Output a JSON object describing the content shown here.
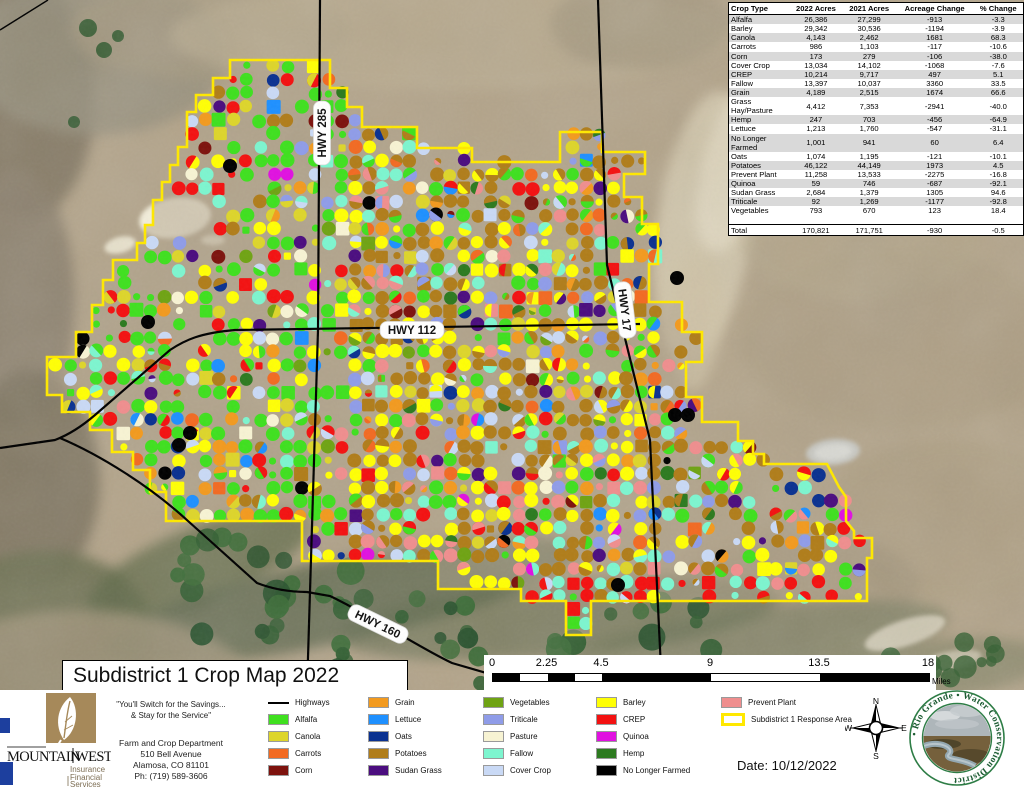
{
  "title": "Subdistrict 1 Crop Map 2022",
  "date_label": "Date: 10/12/2022",
  "highways": [
    "HWY 285",
    "HWY 112",
    "HWY 17",
    "HWY 160"
  ],
  "table": {
    "headers": [
      "Crop Type",
      "2022 Acres",
      "2021 Acres",
      "Acreage Change",
      "% Change"
    ],
    "rows": [
      [
        "Alfalfa",
        "26,386",
        "27,299",
        "-913",
        "-3.3"
      ],
      [
        "Barley",
        "29,342",
        "30,536",
        "-1194",
        "-3.9"
      ],
      [
        "Canola",
        "4,143",
        "2,462",
        "1681",
        "68.3"
      ],
      [
        "Carrots",
        "986",
        "1,103",
        "-117",
        "-10.6"
      ],
      [
        "Corn",
        "173",
        "279",
        "-106",
        "-38.0"
      ],
      [
        "Cover Crop",
        "13,034",
        "14,102",
        "-1068",
        "-7.6"
      ],
      [
        "CREP",
        "10,214",
        "9,717",
        "497",
        "5.1"
      ],
      [
        "Fallow",
        "13,397",
        "10,037",
        "3360",
        "33.5"
      ],
      [
        "Grain",
        "4,189",
        "2,515",
        "1674",
        "66.6"
      ],
      [
        "Grass\nHay/Pasture",
        "4,412",
        "7,353",
        "-2941",
        "-40.0"
      ],
      [
        "Hemp",
        "247",
        "703",
        "-456",
        "-64.9"
      ],
      [
        "Lettuce",
        "1,213",
        "1,760",
        "-547",
        "-31.1"
      ],
      [
        "No Longer\nFarmed",
        "1,001",
        "941",
        "60",
        "6.4"
      ],
      [
        "Oats",
        "1,074",
        "1,195",
        "-121",
        "-10.1"
      ],
      [
        "Potatoes",
        "46,122",
        "44,149",
        "1973",
        "4.5"
      ],
      [
        "Prevent Plant",
        "11,258",
        "13,533",
        "-2275",
        "-16.8"
      ],
      [
        "Quinoa",
        "59",
        "746",
        "-687",
        "-92.1"
      ],
      [
        "Sudan Grass",
        "2,684",
        "1,379",
        "1305",
        "94.6"
      ],
      [
        "Triticale",
        "92",
        "1,269",
        "-1177",
        "-92.8"
      ],
      [
        "Vegetables",
        "793",
        "670",
        "123",
        "18.4"
      ]
    ],
    "total": [
      "Total",
      "170,821",
      "171,751",
      "-930",
      "-0.5"
    ]
  },
  "legend": {
    "columns": [
      [
        {
          "label": "Highways",
          "type": "line",
          "color": "#000000"
        },
        {
          "label": "Alfalfa",
          "color": "#3FE01F"
        },
        {
          "label": "Canola",
          "color": "#DDD52B"
        },
        {
          "label": "Carrots",
          "color": "#F26A22"
        },
        {
          "label": "Corn",
          "color": "#7D120D"
        }
      ],
      [
        {
          "label": "Grain",
          "color": "#F29A1F"
        },
        {
          "label": "Lettuce",
          "color": "#1E90FF"
        },
        {
          "label": "Oats",
          "color": "#0A3190"
        },
        {
          "label": "Potatoes",
          "color": "#B07D1A"
        },
        {
          "label": "Sudan Grass",
          "color": "#4B0D7F"
        }
      ],
      [
        {
          "label": "Vegetables",
          "color": "#6FA313"
        },
        {
          "label": "Triticale",
          "color": "#8F9CE8"
        },
        {
          "label": "Pasture",
          "color": "#F7F3D3"
        },
        {
          "label": "Fallow",
          "color": "#7DF5CF"
        },
        {
          "label": "Cover Crop",
          "color": "#C9D9F5"
        }
      ],
      [
        {
          "label": "Barley",
          "color": "#FFFF05"
        },
        {
          "label": "CREP",
          "color": "#F31111"
        },
        {
          "label": "Quinoa",
          "color": "#E011E0"
        },
        {
          "label": "Hemp",
          "color": "#2C7A1F"
        },
        {
          "label": "No Longer Farmed",
          "color": "#000000"
        }
      ],
      [
        {
          "label": "Prevent Plant",
          "color": "#EF8E8E"
        },
        {
          "label": "Subdistrict 1 Response Area",
          "type": "outline",
          "color": "#FFE800"
        }
      ]
    ]
  },
  "scale_bar": {
    "ticks": [
      "0",
      "2.25",
      "4.5",
      "9",
      "13.5",
      "18"
    ],
    "unit": "Miles"
  },
  "compass": {
    "n": "N",
    "e": "E",
    "s": "S",
    "w": "W"
  },
  "mountain_west": {
    "name_left": "MOUNTAIN",
    "name_right": "WEST",
    "sub1": "Insurance",
    "sub2": "Financial",
    "sub3": "Services",
    "quote_line1": "\"You'll Switch for the Savings...",
    "quote_line2": "& Stay for the Service\"",
    "addr1": "Farm and Crop Department",
    "addr2": "510 Bell Avenue",
    "addr3": "Alamosa, CO 81101",
    "addr4": "Ph: (719) 589-3606"
  },
  "rio_grande": {
    "ring_text": "• Rio Grande • Water Conservation District"
  },
  "map_colors": {
    "boundary": "#FFE800",
    "highway": "#000000",
    "terrain": "#B3A48A"
  }
}
